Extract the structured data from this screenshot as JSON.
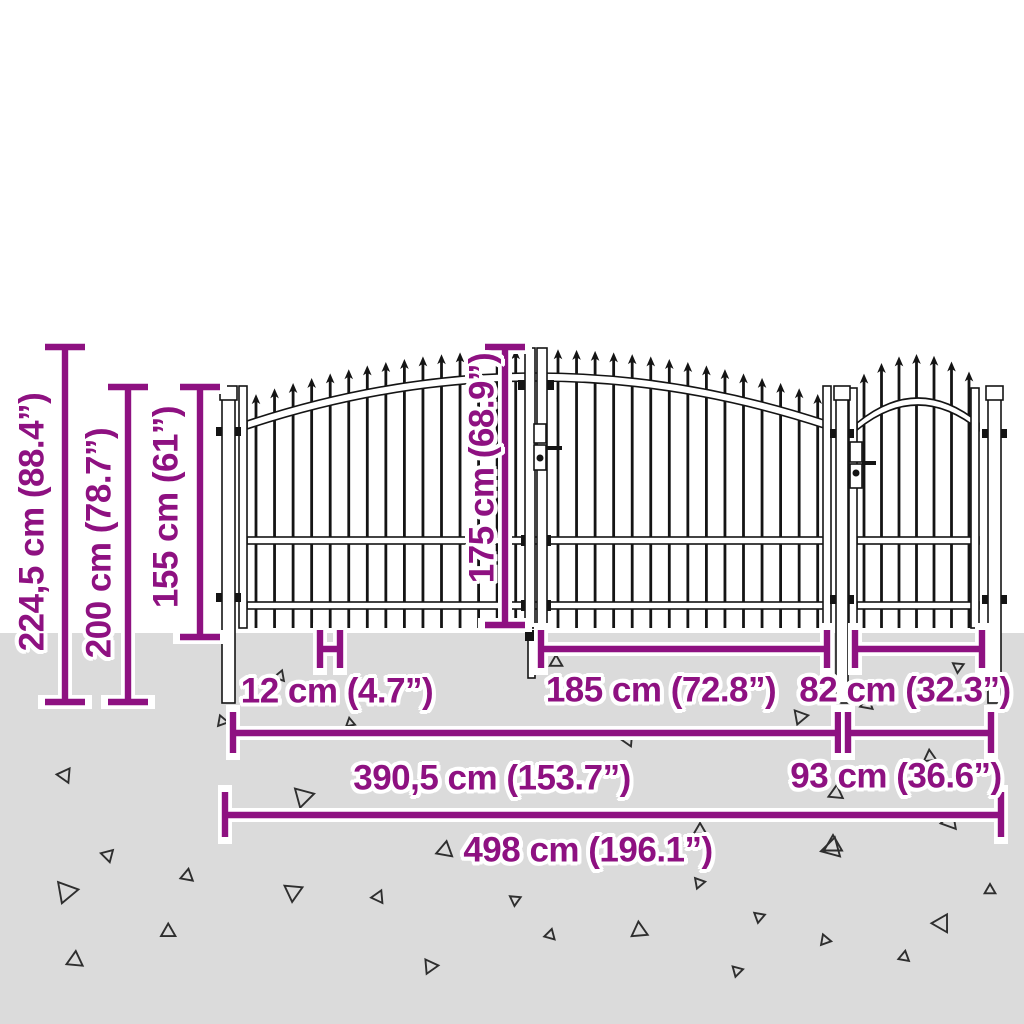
{
  "diagram": {
    "title": "fence-gate-dimension-diagram",
    "colors": {
      "accent": "#8E1181",
      "ground": "#dbdbdb",
      "fence": "#141414"
    },
    "labels": {
      "total_height": "224,5 cm (88.4”)",
      "post_height": "200 cm (78.7”)",
      "fence_height": "155 cm (61”)",
      "gate_height": "175 cm (68.9”)",
      "picket_spacing": "12 cm (4.7”)",
      "gate_leaf_width": "185 cm (72.8”)",
      "single_gate_width": "82 cm (32.3”)",
      "double_gate_width": "390,5 cm (153.7”)",
      "single_gate_total_width": "93 cm (36.6”)",
      "overall_width": "498 cm (196.1”)"
    }
  }
}
